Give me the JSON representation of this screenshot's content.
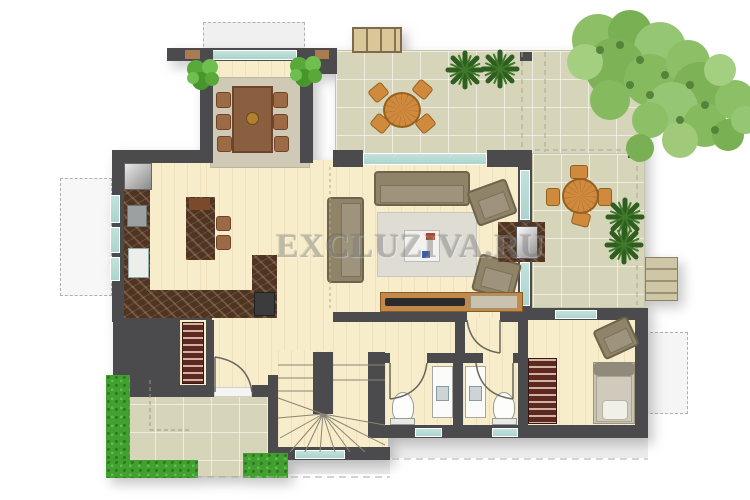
{
  "watermark": {
    "text": "EXCLUZIVA.RU"
  },
  "colors": {
    "wall": "#4b4b4d",
    "floor": "#f7edca",
    "terrace": "#d6d4b9",
    "window": "#abd4cd",
    "counter": "#4f3422",
    "hedge": "#42a030",
    "wood": "#c18a4a",
    "sofa": "#8f8368",
    "rug": "#dedcd3",
    "apron": "#ececec",
    "watermark": "#7d7d7d",
    "tree": "#85bb60",
    "plant_dark": "#2e5e20",
    "patio_wood": "#d08a3e"
  },
  "legend": {
    "areas": [
      "dining area",
      "kitchen",
      "living room",
      "entry hall",
      "winder staircase",
      "wc",
      "wc",
      "bedroom",
      "tiled terrace",
      "entry porch",
      "walkway"
    ],
    "furniture": [
      "dining table with six chairs",
      "kitchen U-counter with sink and hob",
      "kitchen island with two stools",
      "fridge",
      "sofa",
      "loveseat",
      "two armchairs",
      "coffee table",
      "tv console",
      "fireplace",
      "round patio table with four chairs (top terrace)",
      "round patio table with four chairs (side terrace)",
      "garden bench",
      "hall closet",
      "single bed",
      "bedroom wardrobe",
      "bedroom armchair",
      "two toilets",
      "two washbasins"
    ],
    "vegetation": [
      "large tree",
      "four dark potted plants",
      "two indoor plants",
      "green hedge"
    ]
  }
}
